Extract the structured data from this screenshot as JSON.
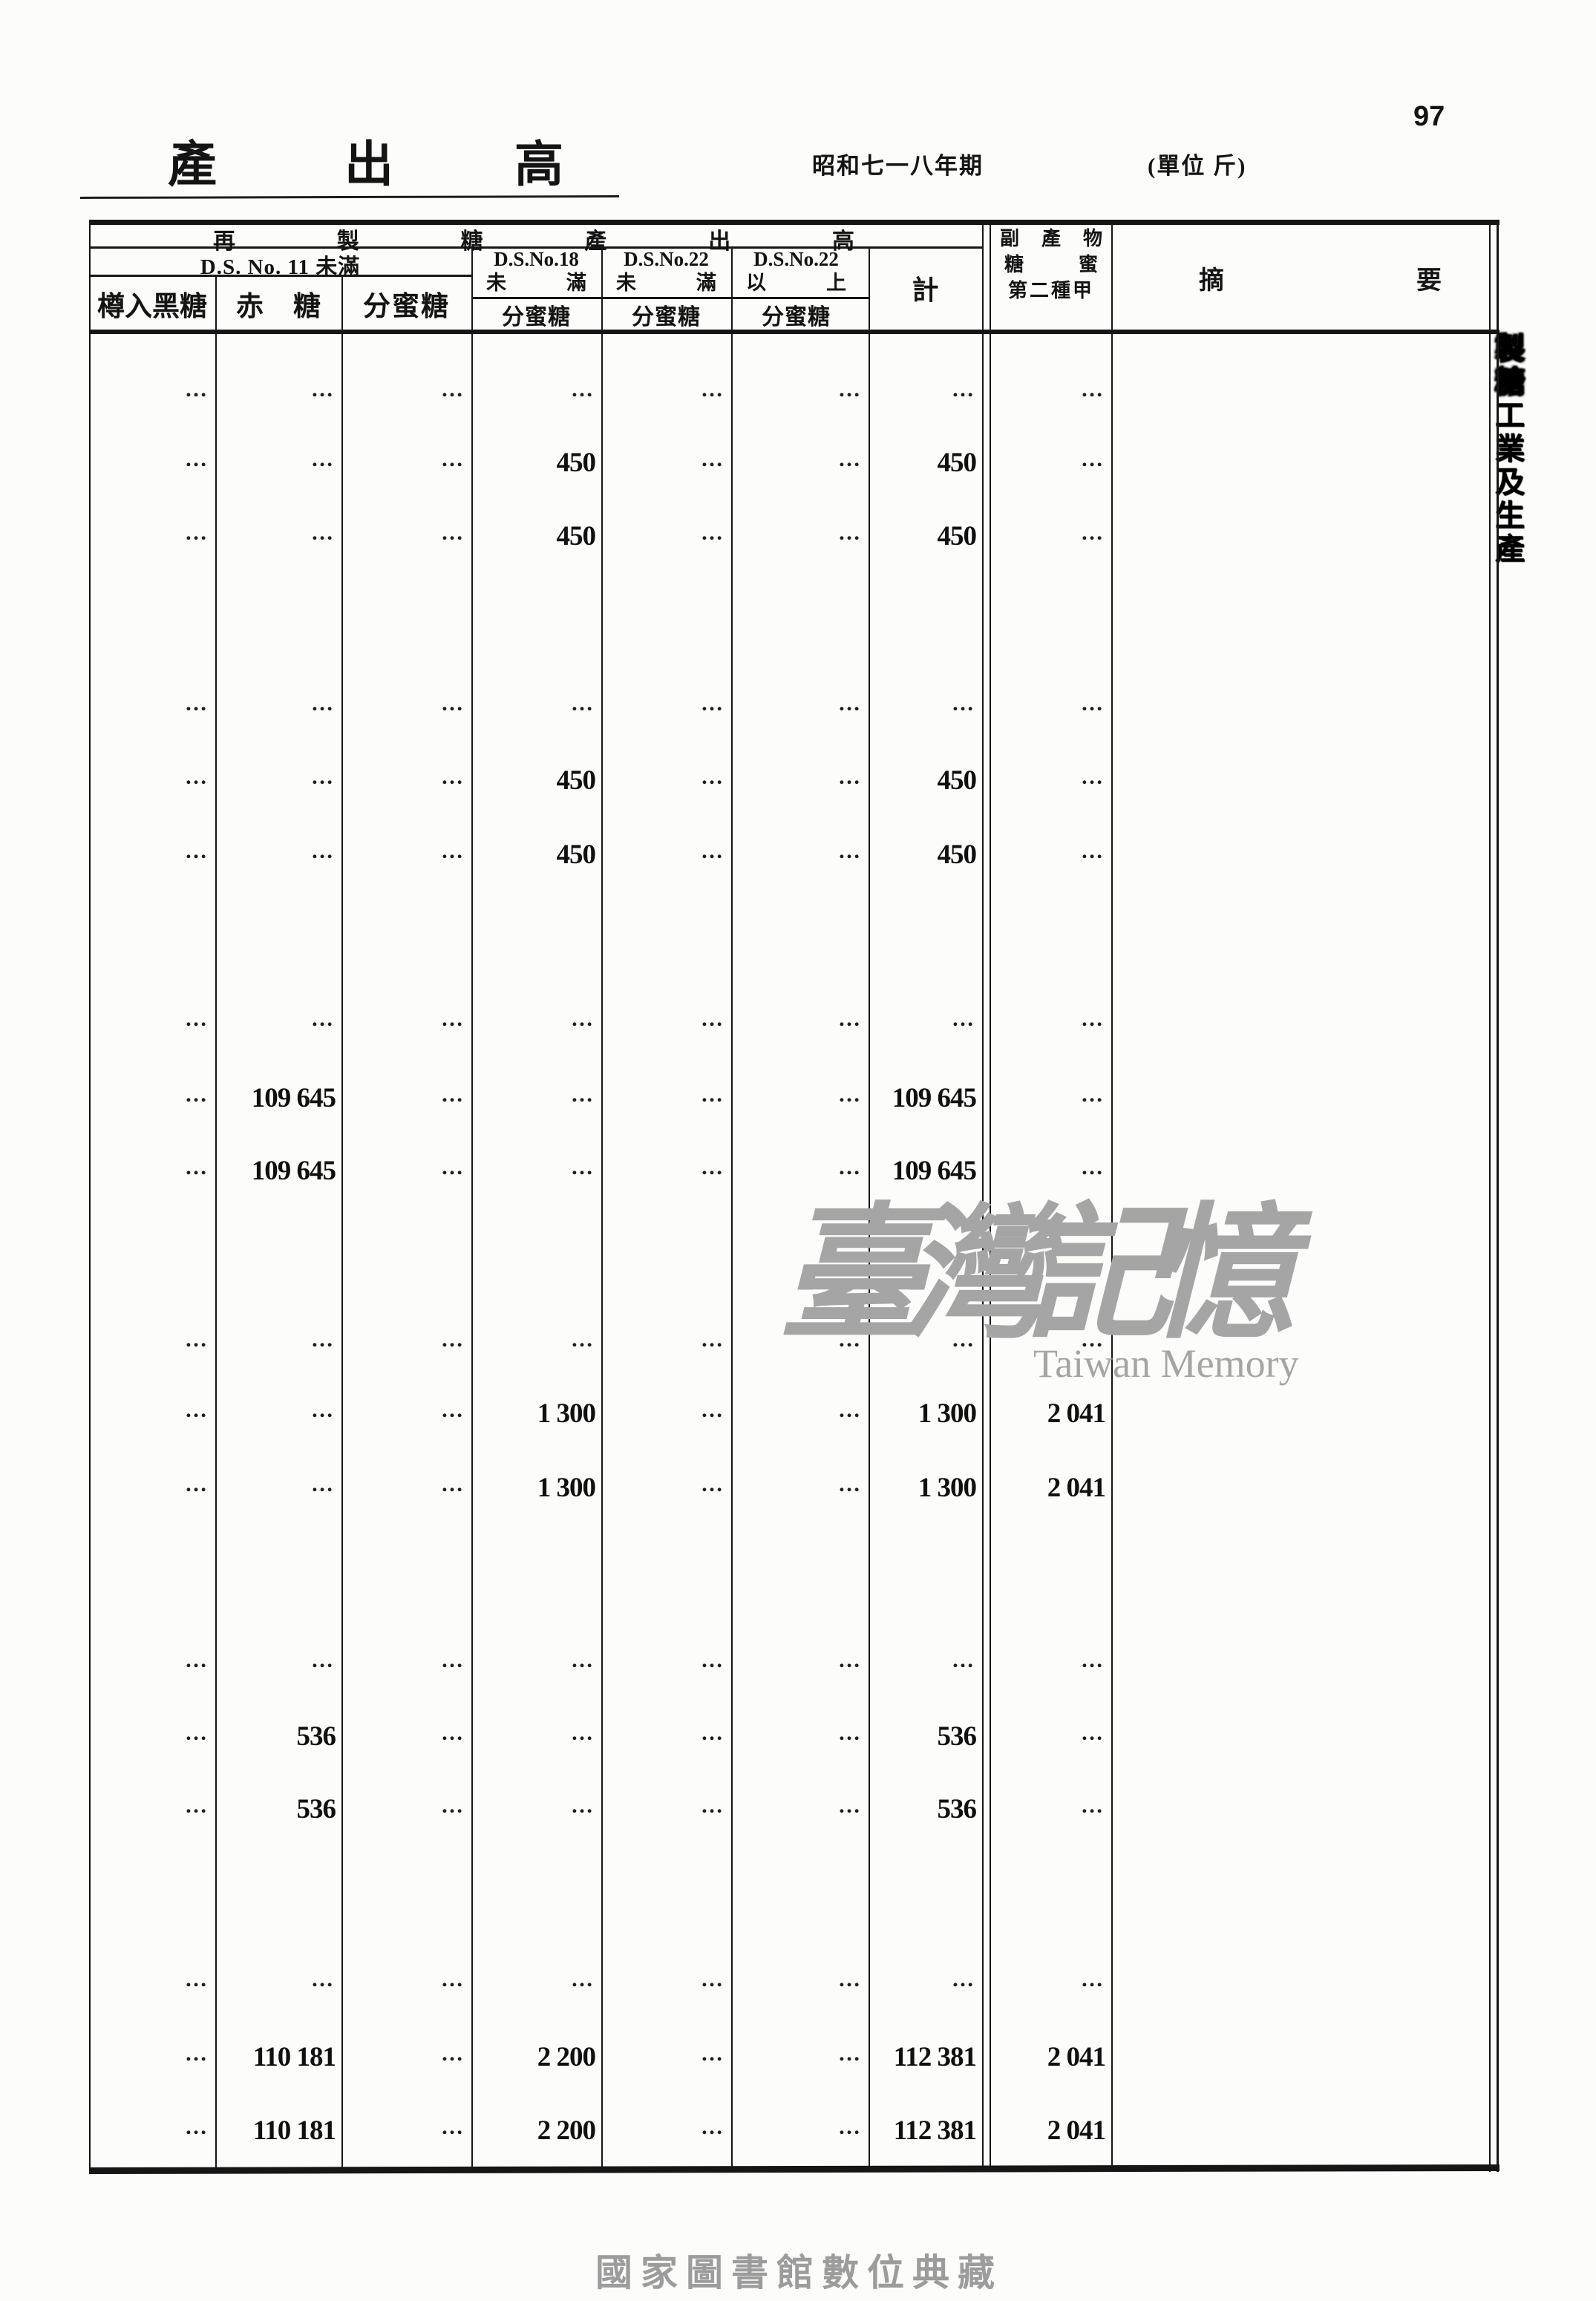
{
  "page": {
    "number": "97",
    "title_chars": [
      "產",
      "出",
      "高"
    ],
    "period": "昭和七一八年期",
    "unit_label": "(單位 斤)",
    "side_caption_heavy": "製糖",
    "side_caption_rest": "工業及生產",
    "watermark_cjk": "臺灣記憶",
    "watermark_latin": "Taiwan Memory",
    "footer": "國家圖書館數位典藏"
  },
  "table": {
    "top_header_chars": [
      "再",
      "製",
      "糖",
      "產",
      "出",
      "高"
    ],
    "ds11_label": "D.S. No. 11 未滿",
    "ds18_line1": "D.S.No.18",
    "ds18_line2": "未 滿",
    "ds22a_line1": "D.S.No.22",
    "ds22a_line2": "未 滿",
    "ds22b_line1": "D.S.No.22",
    "ds22b_line2": "以 上",
    "total_label": "計",
    "byproduct_line1": "副 產 物",
    "byproduct_line2": "糖 蜜",
    "byproduct_line3": "第二種甲",
    "remark_label": "摘 要",
    "sub_headers": [
      "樽入黑糖",
      "赤 糖",
      "分蜜糖",
      "分蜜糖",
      "分蜜糖",
      "分蜜糖"
    ],
    "rows": [
      {
        "cells": [
          "…",
          "…",
          "…",
          "…",
          "…",
          "…",
          "…",
          "…"
        ]
      },
      {
        "cells": [
          "…",
          "…",
          "…",
          "450",
          "…",
          "…",
          "450",
          "…"
        ]
      },
      {
        "cells": [
          "…",
          "…",
          "…",
          "450",
          "…",
          "…",
          "450",
          "…"
        ]
      },
      {
        "cells": [
          "…",
          "…",
          "…",
          "…",
          "…",
          "…",
          "…",
          "…"
        ]
      },
      {
        "cells": [
          "…",
          "…",
          "…",
          "450",
          "…",
          "…",
          "450",
          "…"
        ]
      },
      {
        "cells": [
          "…",
          "…",
          "…",
          "450",
          "…",
          "…",
          "450",
          "…"
        ]
      },
      {
        "cells": [
          "…",
          "…",
          "…",
          "…",
          "…",
          "…",
          "…",
          "…"
        ]
      },
      {
        "cells": [
          "…",
          "109 645",
          "…",
          "…",
          "…",
          "…",
          "109 645",
          "…"
        ]
      },
      {
        "cells": [
          "…",
          "109 645",
          "…",
          "…",
          "…",
          "…",
          "109 645",
          "…"
        ]
      },
      {
        "cells": [
          "…",
          "…",
          "…",
          "…",
          "…",
          "…",
          "…",
          "…"
        ]
      },
      {
        "cells": [
          "…",
          "…",
          "…",
          "1 300",
          "…",
          "…",
          "1 300",
          "2 041"
        ]
      },
      {
        "cells": [
          "…",
          "…",
          "…",
          "1 300",
          "…",
          "…",
          "1 300",
          "2 041"
        ]
      },
      {
        "cells": [
          "…",
          "…",
          "…",
          "…",
          "…",
          "…",
          "…",
          "…"
        ]
      },
      {
        "cells": [
          "…",
          "536",
          "…",
          "…",
          "…",
          "…",
          "536",
          "…"
        ]
      },
      {
        "cells": [
          "…",
          "536",
          "…",
          "…",
          "…",
          "…",
          "536",
          "…"
        ]
      },
      {
        "cells": [
          "…",
          "…",
          "…",
          "…",
          "…",
          "…",
          "…",
          "…"
        ]
      },
      {
        "cells": [
          "…",
          "110 181",
          "…",
          "2 200",
          "…",
          "…",
          "112 381",
          "2 041"
        ]
      },
      {
        "cells": [
          "…",
          "110 181",
          "…",
          "2 200",
          "…",
          "…",
          "112 381",
          "2 041"
        ]
      }
    ]
  }
}
